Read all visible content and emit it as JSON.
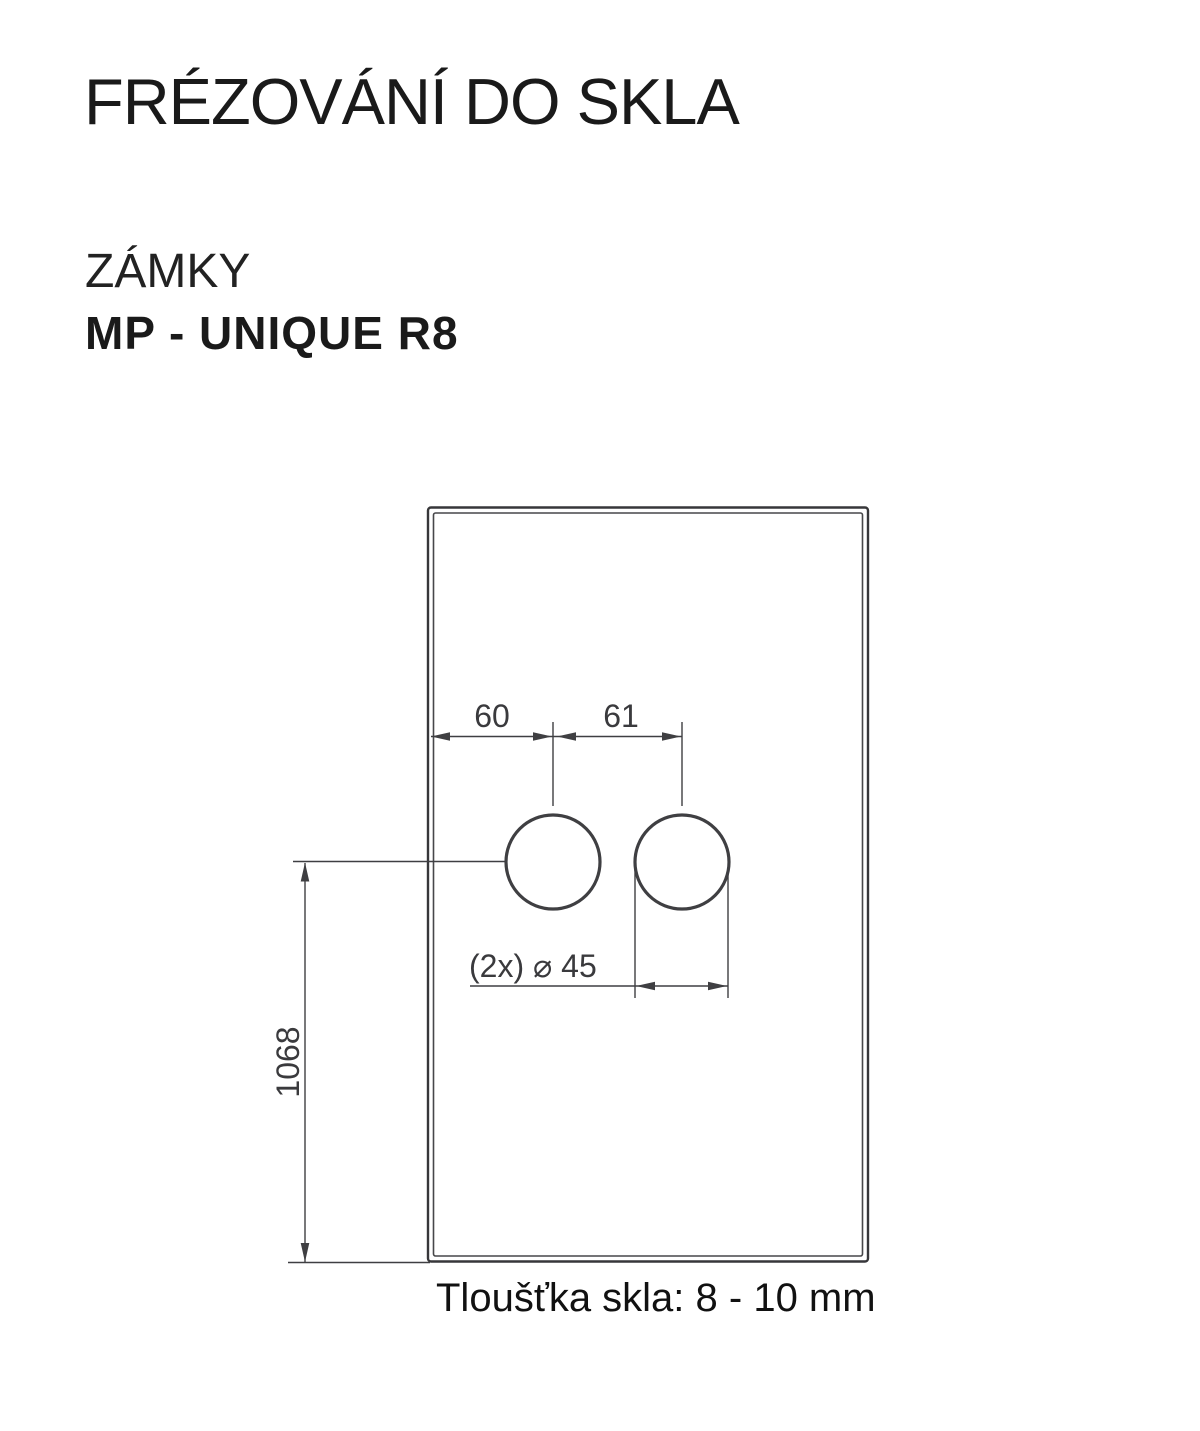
{
  "header": {
    "title": "FRÉZOVÁNÍ DO SKLA",
    "category": "ZÁMKY",
    "product": "MP - UNIQUE R8"
  },
  "drawing": {
    "type": "glass-milling-technical-drawing",
    "labels": {
      "offset_from_edge_mm": "60",
      "hole_spacing_mm": "61",
      "height_from_bottom_mm": "1068",
      "hole_diameter": "(2x) ⌀ 45"
    },
    "holes": {
      "count": 2,
      "diameter_mm": 45,
      "first_hole_center_from_left_edge_mm": 60,
      "center_to_center_mm": 61,
      "centerline_height_from_bottom_mm": 1068
    },
    "caption": "Tloušťka skla: 8 - 10 mm",
    "colors": {
      "line": "#3f3f42",
      "dim_text": "#3a3a3d",
      "heading_ink": "#1a1a1a",
      "background": "#ffffff"
    }
  }
}
